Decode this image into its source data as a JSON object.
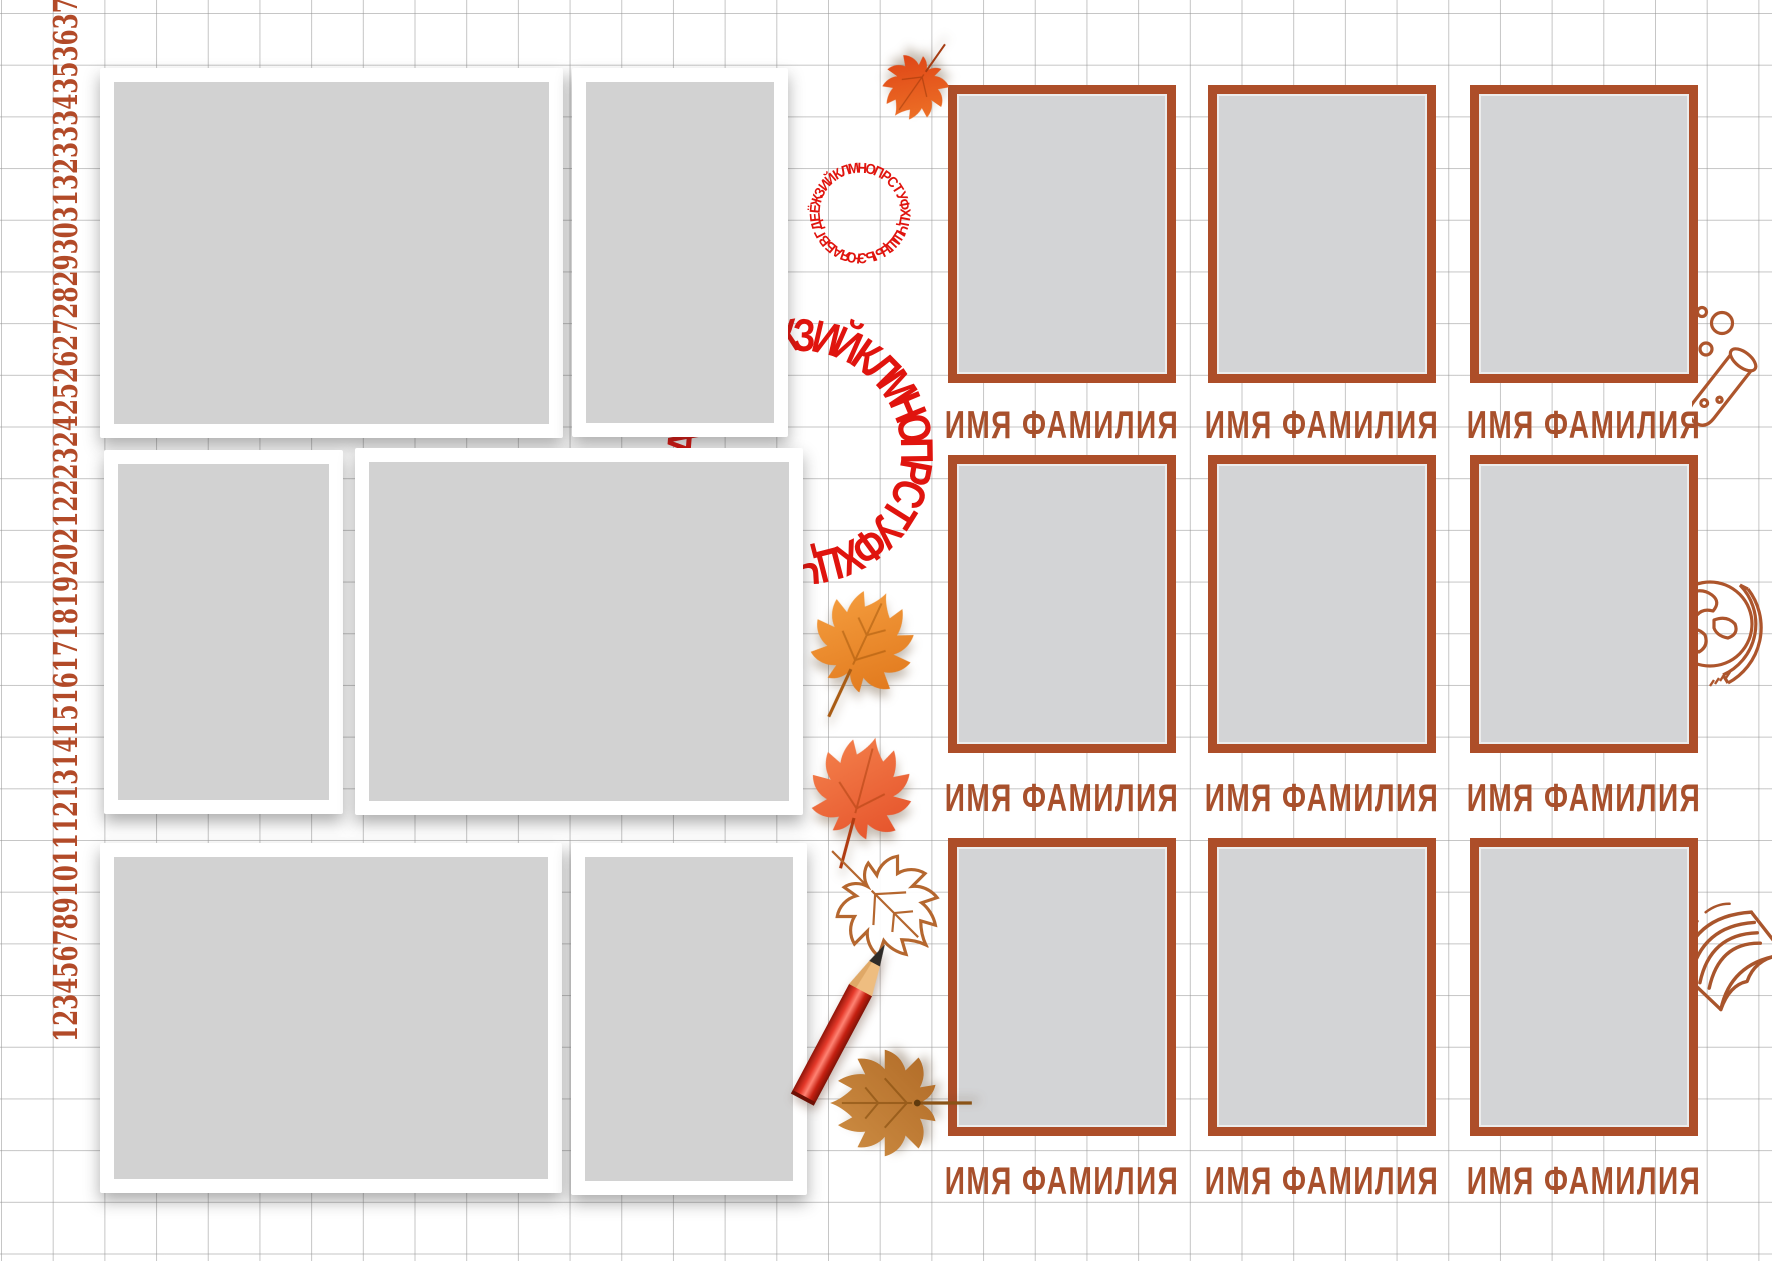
{
  "ruler": {
    "numbers": "1234567891011121314151617181920212223242526272829303132333435363738394041",
    "numbers_visible": "123456789101112131415161718192021222324252627282930313233343536373839",
    "numbers_full": "1234567891011121314151617181920212223242526272829303132333435363738394 0",
    "text": "123456789101112131415161718192021222324252627282930313233343536373839"
  },
  "ruler_fixed": {
    "text": "1234567891011121314151617181920212223242526272829303132333435363738394"
  },
  "ruler_final": {
    "text": "123456789101112131415161718192021222324252627282930313233343536373839 40"
  },
  "ruler_display": {
    "text": "1234567891011121314151617181920212223242526272829303132333435363738394041"
  },
  "ruler_numbers": "123456789101112131415161718192021222324252627282930313233343536373839",
  "numbers_strip": "1234567891011121314151617181920212223242526272829303132333435363738394 0",
  "left_ruler": {
    "numbers": "123456789",
    "tens": "10111213141516171819",
    "twenties": "20212223242526272829",
    "thirties": "30313233343536373839",
    "last": "40",
    "full": "1234567891011121314151617181920212223242526272829303132333435363738394 0"
  },
  "strip": {
    "text": "123456789"
  },
  "ruler_joined": {
    "text": "1234567891011121314151617181920212223242526272829303132333435363738394 0"
  },
  "vertical_ruler": {
    "text": "1234567891011121314151617181920212223242526272829303132333435363738394041"
  },
  "numbers": {
    "text": "123456789101112131415161718192021222324252627282930313233343536373839",
    "tail": "40"
  },
  "alphabet_rings": {
    "text": "АБВГДЕЁЖЗИЙКЛМНОПРСТУФХЦЧШЩЪЫЬЭЮЯ",
    "color": "#e0140e"
  },
  "roster": {
    "rows": 3,
    "cols": 3,
    "labels": [
      "ИМЯ ФАМИЛИЯ",
      "ИМЯ ФАМИЛИЯ",
      "ИМЯ ФАМИЛИЯ",
      "ИМЯ ФАМИЛИЯ",
      "ИМЯ ФАМИЛИЯ",
      "ИМЯ ФАМИЛИЯ",
      "ИМЯ ФАМИЛИЯ",
      "ИМЯ ФАМИЛИЯ",
      "ИМЯ ФАМИЛИЯ"
    ]
  },
  "placeholders": {
    "left_photo_cards": 6,
    "portrait_frames": 9
  },
  "decorations": [
    "maple-leaf-top",
    "maple-leaf-orange",
    "maple-leaf-red",
    "maple-leaf-outline",
    "maple-leaf-brown",
    "red-pencil",
    "test-tube-doodle",
    "globe-doodle",
    "book-doodle",
    "alphabet-ring-small",
    "alphabet-ring-large"
  ],
  "colors": {
    "frame_brown": "#ad4e29",
    "label_brown": "#a8502c",
    "ruler_red": "#b24a28",
    "ring_red": "#e0140e",
    "grid_line": "#b0b0b0",
    "placeholder_gray": "#d2d2d2",
    "leaf_orange": "#ef8a2d",
    "leaf_red": "#ea5a2f",
    "leaf_brown": "#c4813a"
  }
}
